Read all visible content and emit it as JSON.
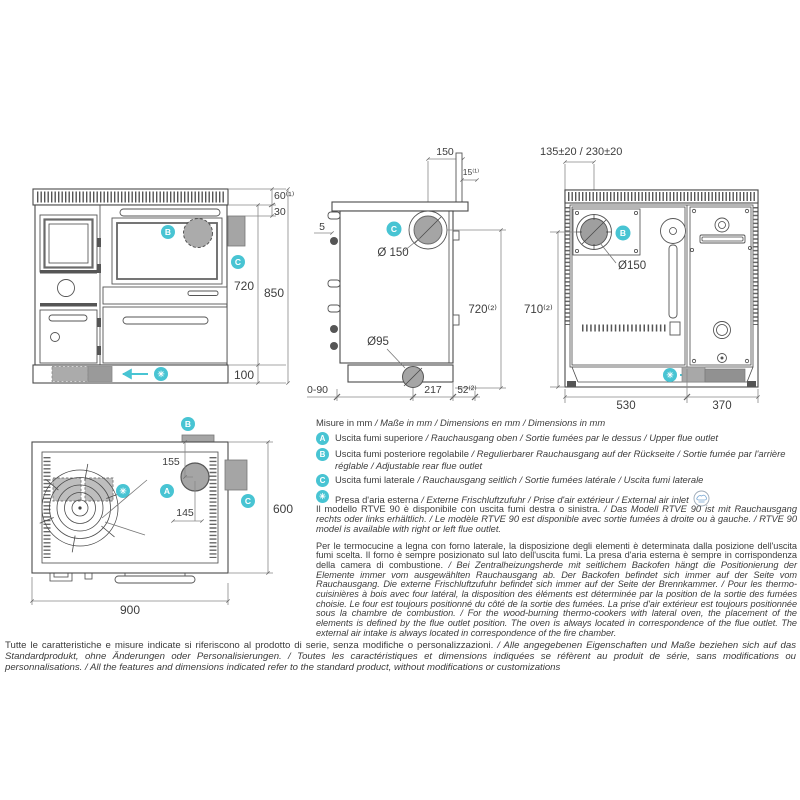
{
  "accent": "#48c4d3",
  "gray_fill": "#a5a5a5",
  "badges": {
    "a": "A",
    "b": "B",
    "c": "C",
    "air": "✳"
  },
  "views": {
    "front": {
      "dim_60": "60⁽¹⁾",
      "dim_30": "30",
      "dim_720": "720",
      "dim_850": "850",
      "dim_100": "100"
    },
    "side": {
      "dim_150": "150",
      "dim_15": "15⁽¹⁾",
      "dim_5": "5",
      "dim_flue": "Ø 150",
      "dim_720": "720⁽²⁾",
      "dim_95": "Ø95",
      "dim_090": "0-90",
      "dim_217": "217",
      "dim_52": "52⁽²⁾"
    },
    "rear": {
      "dim_top": "135±20 / 230±20",
      "dim_flue": "Ø150",
      "dim_710": "710⁽²⁾",
      "dim_530": "530",
      "dim_370": "370"
    },
    "top": {
      "dim_155": "155",
      "dim_145": "145",
      "dim_600": "600",
      "dim_900": "900"
    }
  },
  "legend": {
    "units": {
      "plain": "Misure in mm",
      "italic": " / Maße in mm / Dimensions en mm / Dimensions in mm"
    },
    "items": [
      {
        "badge": "A",
        "plain": "Uscita fumi superiore",
        "italic": " / Rauchausgang oben  / Sortie fumées par le dessus / Upper flue outlet"
      },
      {
        "badge": "B",
        "plain": "Uscita fumi posteriore regolabile",
        "italic": " / Regulierbarer Rauchausgang auf der Rückseite / Sortie fumée par l'arrière réglable / Adjustable rear flue outlet"
      },
      {
        "badge": "C",
        "plain": "Uscita fumi laterale",
        "italic": " / Rauchausgang seitlich  / Sortie fumées latérale / Uscita fumi laterale"
      },
      {
        "badge": "✳",
        "plain": "Presa d'aria esterna",
        "italic": " / Externe Frischluftzufuhr / Prise d'air extérieur / External air inlet"
      }
    ]
  },
  "paragraphs": {
    "p1": {
      "plain": "Il modello RTVE 90 è disponibile con uscita fumi destra o sinistra.",
      "italic": " / Das Modell RTVE 90 ist mit Rauchausgang rechts oder links erhältlich. / Le modèle RTVE 90 est disponible avec sortie fumées à droite ou à gauche. / RTVE 90 model is available with right or left flue outlet."
    },
    "p2": {
      "plain": "Per le termocucine a legna con forno laterale, la disposizione degli elementi è determinata dalla posizione dell'uscita fumi scelta. Il forno è sempre posizionato sul lato dell'uscita fumi. La presa d'aria esterna è sempre in corrispondenza della camera di combustione.",
      "italic": " / Bei Zentralheizungsherde mit seitlichem Backofen hängt die Positionierung der Elemente immer vom ausgewählten Rauchausgang ab. Der Backofen befindet sich immer auf der Seite vom Rauchausgang. Die externe Frischluftzufuhr befindet sich immer auf der Seite der Brennkammer. / Pour les thermo-cuisinières à bois avec four latéral, la disposition des éléments est déterminée par la position de la sortie des fumées choisie. Le four est toujours positionné du côté de la sortie des fumées. La prise d'air extérieur est toujours positionnée sous la chambre de combustion. / For the wood-burning thermo-cookers with lateral oven, the placement of the elements is defined by the flue outlet position. The oven is always located in correspondence of the flue outlet. The external air intake is always located in correspondence of the fire chamber."
    }
  },
  "footer": {
    "plain": "Tutte le caratteristiche e misure indicate si riferiscono al prodotto di serie, senza modifiche o personalizzazioni.",
    "italic": " / Alle angegebenen Eigenschaften und Maße beziehen sich auf das Standardprodukt, ohne Änderungen oder Personalisierungen. / Toutes les caractéristiques et dimensions indiquées se réfèrent au produit de série, sans modifications ou personnalisations. / All the features and dimensions indicated refer to the standard product, without modifications or customizations"
  }
}
